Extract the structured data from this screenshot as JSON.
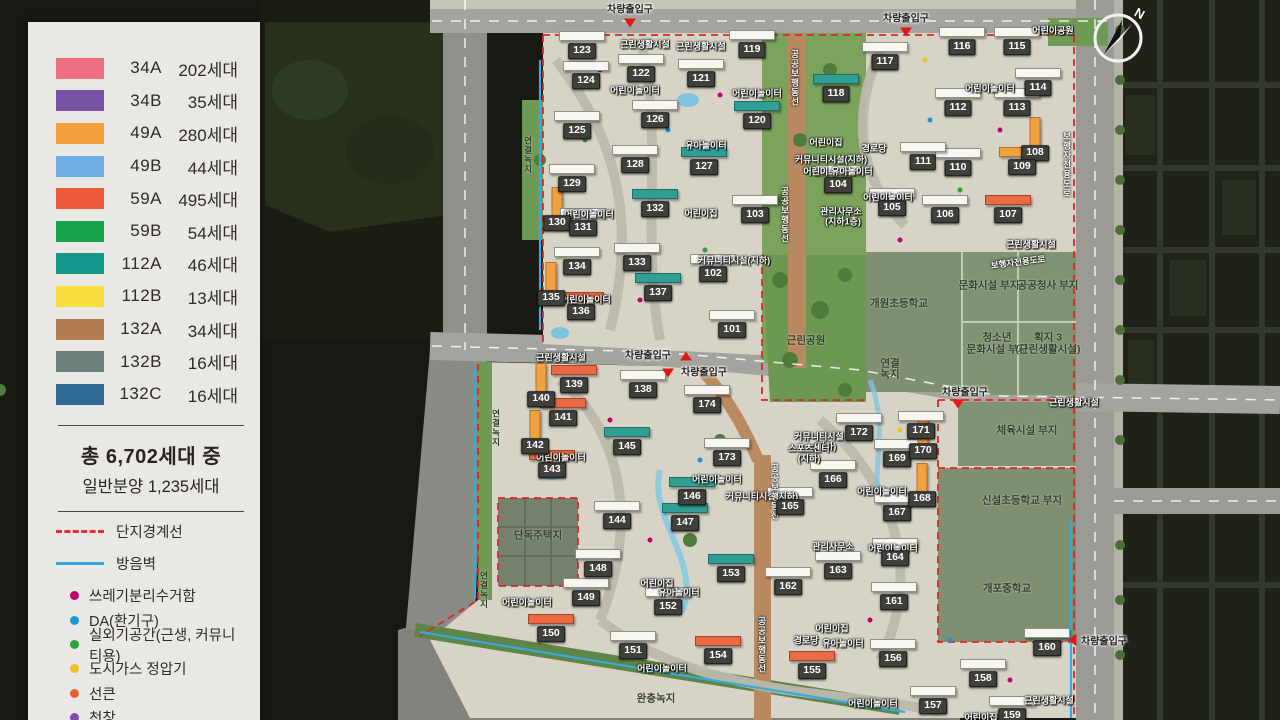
{
  "legend": {
    "unit_types": [
      {
        "code": "34A",
        "count": "202세대",
        "color": "#ee6f80"
      },
      {
        "code": "34B",
        "count": "35세대",
        "color": "#7a52a3"
      },
      {
        "code": "49A",
        "count": "280세대",
        "color": "#f4a03a"
      },
      {
        "code": "49B",
        "count": "44세대",
        "color": "#6fade5"
      },
      {
        "code": "59A",
        "count": "495세대",
        "color": "#ee5a3a"
      },
      {
        "code": "59B",
        "count": "54세대",
        "color": "#19a349"
      },
      {
        "code": "112A",
        "count": "46세대",
        "color": "#11998e"
      },
      {
        "code": "112B",
        "count": "13세대",
        "color": "#f7de3d"
      },
      {
        "code": "132A",
        "count": "34세대",
        "color": "#b17c52"
      },
      {
        "code": "132B",
        "count": "16세대",
        "color": "#6d817c"
      },
      {
        "code": "132C",
        "count": "16세대",
        "color": "#2f6b95"
      }
    ],
    "total_line1": "총 6,702세대 중",
    "total_line2": "일반분양 1,235세대",
    "line_items": [
      {
        "label": "단지경계선",
        "style": "boundary",
        "color": "#e03030"
      },
      {
        "label": "방음벽",
        "style": "wall",
        "color": "#2fa7e0"
      }
    ],
    "marker_items": [
      {
        "label": "쓰레기분리수거함",
        "color": "#c4006e",
        "shape": "dot"
      },
      {
        "label": "DA(환기구)",
        "color": "#1e96d2",
        "shape": "dot"
      },
      {
        "label": "실외기공간(근생, 커뮤니티용)",
        "color": "#2ca03c",
        "shape": "dot"
      },
      {
        "label": "도시가스 정압기",
        "color": "#f0c028",
        "shape": "dot"
      },
      {
        "label": "선큰",
        "color": "#e0603a",
        "shape": "dot"
      },
      {
        "label": "천창",
        "color": "#8050a8",
        "shape": "dot"
      },
      {
        "label": "민방위급수시설",
        "color": "#ffffff",
        "shape": "square"
      }
    ]
  },
  "map": {
    "compass_n": "N",
    "buildings": [
      {
        "n": "101",
        "x": 732,
        "y": 330
      },
      {
        "n": "102",
        "x": 713,
        "y": 274
      },
      {
        "n": "103",
        "x": 755,
        "y": 215
      },
      {
        "n": "104",
        "x": 838,
        "y": 185
      },
      {
        "n": "105",
        "x": 892,
        "y": 208
      },
      {
        "n": "106",
        "x": 945,
        "y": 215
      },
      {
        "n": "107",
        "x": 1008,
        "y": 215,
        "c": "r"
      },
      {
        "n": "108",
        "x": 1035,
        "y": 153,
        "c": "o",
        "vert": true
      },
      {
        "n": "109",
        "x": 1022,
        "y": 167,
        "c": "o"
      },
      {
        "n": "110",
        "x": 958,
        "y": 168
      },
      {
        "n": "111",
        "x": 923,
        "y": 162
      },
      {
        "n": "112",
        "x": 958,
        "y": 108
      },
      {
        "n": "113",
        "x": 1017,
        "y": 108
      },
      {
        "n": "114",
        "x": 1038,
        "y": 88
      },
      {
        "n": "115",
        "x": 1017,
        "y": 47
      },
      {
        "n": "116",
        "x": 962,
        "y": 47
      },
      {
        "n": "117",
        "x": 885,
        "y": 62
      },
      {
        "n": "118",
        "x": 836,
        "y": 94,
        "c": "t"
      },
      {
        "n": "119",
        "x": 752,
        "y": 50
      },
      {
        "n": "120",
        "x": 757,
        "y": 121,
        "c": "t"
      },
      {
        "n": "121",
        "x": 701,
        "y": 79
      },
      {
        "n": "122",
        "x": 641,
        "y": 74
      },
      {
        "n": "123",
        "x": 582,
        "y": 51
      },
      {
        "n": "124",
        "x": 586,
        "y": 81
      },
      {
        "n": "125",
        "x": 577,
        "y": 131
      },
      {
        "n": "126",
        "x": 655,
        "y": 120
      },
      {
        "n": "127",
        "x": 704,
        "y": 167,
        "c": "t"
      },
      {
        "n": "128",
        "x": 635,
        "y": 165
      },
      {
        "n": "129",
        "x": 572,
        "y": 184
      },
      {
        "n": "130",
        "x": 557,
        "y": 223,
        "c": "o",
        "vert": true
      },
      {
        "n": "131",
        "x": 583,
        "y": 228
      },
      {
        "n": "132",
        "x": 655,
        "y": 209,
        "c": "t"
      },
      {
        "n": "133",
        "x": 637,
        "y": 263
      },
      {
        "n": "134",
        "x": 577,
        "y": 267
      },
      {
        "n": "135",
        "x": 551,
        "y": 298,
        "c": "o",
        "vert": true
      },
      {
        "n": "136",
        "x": 581,
        "y": 312,
        "c": "r"
      },
      {
        "n": "137",
        "x": 658,
        "y": 293,
        "c": "t"
      },
      {
        "n": "138",
        "x": 643,
        "y": 390
      },
      {
        "n": "139",
        "x": 574,
        "y": 385,
        "c": "r"
      },
      {
        "n": "140",
        "x": 541,
        "y": 399,
        "c": "o",
        "vert": true
      },
      {
        "n": "141",
        "x": 563,
        "y": 418,
        "c": "r"
      },
      {
        "n": "142",
        "x": 535,
        "y": 446,
        "c": "o",
        "vert": true
      },
      {
        "n": "143",
        "x": 552,
        "y": 470,
        "c": "r"
      },
      {
        "n": "144",
        "x": 617,
        "y": 521
      },
      {
        "n": "145",
        "x": 627,
        "y": 447,
        "c": "t"
      },
      {
        "n": "146",
        "x": 692,
        "y": 497,
        "c": "t"
      },
      {
        "n": "147",
        "x": 685,
        "y": 523,
        "c": "t"
      },
      {
        "n": "148",
        "x": 598,
        "y": 569
      },
      {
        "n": "149",
        "x": 586,
        "y": 598
      },
      {
        "n": "150",
        "x": 551,
        "y": 634,
        "c": "r"
      },
      {
        "n": "151",
        "x": 633,
        "y": 651
      },
      {
        "n": "152",
        "x": 668,
        "y": 607
      },
      {
        "n": "153",
        "x": 731,
        "y": 574,
        "c": "t"
      },
      {
        "n": "154",
        "x": 718,
        "y": 656,
        "c": "r"
      },
      {
        "n": "155",
        "x": 812,
        "y": 671,
        "c": "r"
      },
      {
        "n": "156",
        "x": 893,
        "y": 659
      },
      {
        "n": "157",
        "x": 933,
        "y": 706
      },
      {
        "n": "158",
        "x": 983,
        "y": 679
      },
      {
        "n": "159",
        "x": 1012,
        "y": 716
      },
      {
        "n": "160",
        "x": 1047,
        "y": 648
      },
      {
        "n": "161",
        "x": 894,
        "y": 602
      },
      {
        "n": "162",
        "x": 788,
        "y": 587
      },
      {
        "n": "163",
        "x": 838,
        "y": 571
      },
      {
        "n": "164",
        "x": 895,
        "y": 558
      },
      {
        "n": "165",
        "x": 790,
        "y": 507
      },
      {
        "n": "166",
        "x": 833,
        "y": 480
      },
      {
        "n": "167",
        "x": 897,
        "y": 513
      },
      {
        "n": "168",
        "x": 922,
        "y": 499,
        "c": "o",
        "vert": true
      },
      {
        "n": "169",
        "x": 897,
        "y": 459
      },
      {
        "n": "170",
        "x": 923,
        "y": 451,
        "c": "o",
        "vert": true
      },
      {
        "n": "171",
        "x": 921,
        "y": 431
      },
      {
        "n": "172",
        "x": 859,
        "y": 433
      },
      {
        "n": "173",
        "x": 727,
        "y": 458
      },
      {
        "n": "174",
        "x": 707,
        "y": 405
      }
    ],
    "labels": [
      {
        "t": "근린생활시설",
        "x": 645,
        "y": 44,
        "k": "lf"
      },
      {
        "t": "근린생활시설",
        "x": 701,
        "y": 46,
        "k": "lf"
      },
      {
        "t": "근린생활시설",
        "x": 1031,
        "y": 244,
        "k": "lf"
      },
      {
        "t": "근린생활시설",
        "x": 561,
        "y": 357,
        "k": "lf"
      },
      {
        "t": "근린생활시설",
        "x": 1074,
        "y": 402,
        "k": "lf"
      },
      {
        "t": "근린생활시설",
        "x": 1049,
        "y": 700,
        "k": "lf"
      },
      {
        "t": "어린이놀이터",
        "x": 635,
        "y": 90,
        "k": "lf"
      },
      {
        "t": "어린이놀이터",
        "x": 757,
        "y": 93,
        "k": "lf"
      },
      {
        "t": "어린이놀이터",
        "x": 990,
        "y": 88,
        "k": "lf"
      },
      {
        "t": "어린이놀이터",
        "x": 589,
        "y": 214,
        "k": "lf"
      },
      {
        "t": "어린이놀이터",
        "x": 888,
        "y": 197,
        "k": "lf"
      },
      {
        "t": "어린이놀이터",
        "x": 586,
        "y": 299,
        "k": "lf"
      },
      {
        "t": "어린이놀이터",
        "x": 561,
        "y": 457,
        "k": "lf"
      },
      {
        "t": "어린이놀이터",
        "x": 527,
        "y": 602,
        "k": "lf"
      },
      {
        "t": "어린이놀이터",
        "x": 717,
        "y": 479,
        "k": "lf"
      },
      {
        "t": "어린이놀이터",
        "x": 882,
        "y": 491,
        "k": "lf"
      },
      {
        "t": "어린이놀이터",
        "x": 893,
        "y": 548,
        "k": "lf"
      },
      {
        "t": "어린이놀이터",
        "x": 873,
        "y": 703,
        "k": "lf"
      },
      {
        "t": "어린이놀이터",
        "x": 662,
        "y": 668,
        "k": "lf"
      },
      {
        "t": "유아놀이터",
        "x": 706,
        "y": 145,
        "k": "lf"
      },
      {
        "t": "유아놀이터",
        "x": 679,
        "y": 592,
        "k": "lf"
      },
      {
        "t": "유아놀이터",
        "x": 843,
        "y": 643,
        "k": "lf"
      },
      {
        "t": "어린이집",
        "x": 826,
        "y": 142,
        "k": "lf"
      },
      {
        "t": "어린이집",
        "x": 701,
        "y": 213,
        "k": "lf"
      },
      {
        "t": "어린이집",
        "x": 657,
        "y": 583,
        "k": "lf"
      },
      {
        "t": "어린이집",
        "x": 832,
        "y": 628,
        "k": "lf"
      },
      {
        "t": "어린이집",
        "x": 981,
        "y": 717,
        "k": "lf"
      },
      {
        "t": "경로당",
        "x": 874,
        "y": 148,
        "k": "lf"
      },
      {
        "t": "경로당",
        "x": 806,
        "y": 640,
        "k": "lf"
      },
      {
        "t": "커뮤니티시설(지하)",
        "x": 831,
        "y": 159,
        "k": "lf"
      },
      {
        "t": "커뮤니티시설(지하)",
        "x": 734,
        "y": 260,
        "k": "lf"
      },
      {
        "t": "커뮤니티시설",
        "x": 819,
        "y": 436,
        "k": "lf"
      },
      {
        "t": "(지하)",
        "x": 825,
        "y": 446,
        "k": "lf"
      },
      {
        "t": "커뮤니티시설(지하)",
        "x": 762,
        "y": 496,
        "k": "lf"
      },
      {
        "t": "어린이·유아놀이터",
        "x": 838,
        "y": 171,
        "k": "lf"
      },
      {
        "t": "관리사무소",
        "x": 841,
        "y": 211,
        "k": "lf"
      },
      {
        "t": "(지하1층)",
        "x": 843,
        "y": 221,
        "k": "lf"
      },
      {
        "t": "관리사무소",
        "x": 833,
        "y": 546,
        "k": "lf"
      },
      {
        "t": "스포츠센터",
        "x": 809,
        "y": 448,
        "k": "lf"
      },
      {
        "t": "(지하)",
        "x": 809,
        "y": 458,
        "k": "lf"
      },
      {
        "t": "단독주택지",
        "x": 538,
        "y": 535,
        "k": "lp"
      },
      {
        "t": "근린공원",
        "x": 806,
        "y": 340,
        "k": "lp"
      },
      {
        "t": "개원초등학교",
        "x": 899,
        "y": 303,
        "k": "lp"
      },
      {
        "t": "개포중학교",
        "x": 1007,
        "y": 588,
        "k": "lp"
      },
      {
        "t": "신설초등학교 부지",
        "x": 1022,
        "y": 500,
        "k": "lp"
      },
      {
        "t": "문화시설 부지",
        "x": 989,
        "y": 285,
        "k": "lp"
      },
      {
        "t": "공공청사 부지",
        "x": 1048,
        "y": 285,
        "k": "lp"
      },
      {
        "t": "청소년",
        "x": 997,
        "y": 337,
        "k": "lp"
      },
      {
        "t": "문화시설 부지",
        "x": 997,
        "y": 349,
        "k": "lp"
      },
      {
        "t": "획지 3",
        "x": 1048,
        "y": 337,
        "k": "lp"
      },
      {
        "t": "(근린생활시설)",
        "x": 1048,
        "y": 349,
        "k": "lp"
      },
      {
        "t": "체육시설 부지",
        "x": 1027,
        "y": 430,
        "k": "lp"
      },
      {
        "t": "어린이공원",
        "x": 1053,
        "y": 30,
        "k": "lf"
      },
      {
        "t": "연결",
        "x": 890,
        "y": 363,
        "k": "lp"
      },
      {
        "t": "녹지",
        "x": 890,
        "y": 374,
        "k": "lp"
      },
      {
        "t": "완충녹지",
        "x": 656,
        "y": 698,
        "k": "lp"
      },
      {
        "t": "공공보행동선",
        "x": 795,
        "y": 78,
        "k": "lv"
      },
      {
        "t": "공공보행동선",
        "x": 785,
        "y": 215,
        "k": "lv"
      },
      {
        "t": "공공보행동선",
        "x": 775,
        "y": 492,
        "k": "lv"
      },
      {
        "t": "공공보행동선",
        "x": 762,
        "y": 645,
        "k": "lv"
      },
      {
        "t": "보행자전용도로",
        "x": 1067,
        "y": 165,
        "k": "lv"
      },
      {
        "t": "보행자전용도로",
        "x": 1018,
        "y": 262,
        "k": "ld"
      },
      {
        "t": "연결녹지",
        "x": 528,
        "y": 155,
        "k": "lvd"
      },
      {
        "t": "연결녹지",
        "x": 496,
        "y": 428,
        "k": "lvd"
      },
      {
        "t": "연결녹지",
        "x": 484,
        "y": 590,
        "k": "lvd"
      }
    ],
    "entrances": [
      {
        "t": "차량출입구",
        "x": 630,
        "y": 8,
        "tri": "down",
        "tx": 630,
        "ty": 23
      },
      {
        "t": "차량출입구",
        "x": 906,
        "y": 17,
        "tri": "down",
        "tx": 906,
        "ty": 32
      },
      {
        "t": "차량출입구",
        "x": 648,
        "y": 354,
        "tri": "up",
        "tx": 686,
        "ty": 356
      },
      {
        "t": "차량출입구",
        "x": 704,
        "y": 371,
        "tri": "down",
        "tx": 668,
        "ty": 373
      },
      {
        "t": "차량출입구",
        "x": 965,
        "y": 391,
        "tri": "down",
        "tx": 958,
        "ty": 404
      },
      {
        "t": "차량출입구",
        "x": 1104,
        "y": 640,
        "tri": "left",
        "tx": 1072,
        "ty": 640
      }
    ]
  }
}
